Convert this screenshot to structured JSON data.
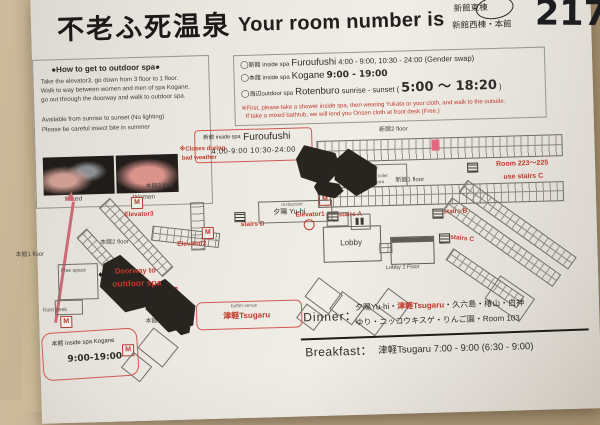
{
  "colors": {
    "table": "#b3a081",
    "paper": "#eae7e1",
    "accent_red": "#c0392b",
    "highlight_room": "#e2697f",
    "arrow_pink": "#c96a74"
  },
  "header": {
    "onsen_title": "不老ふ死温泉",
    "room_number_label": "Your room number is",
    "wing_circled": "新館東棟",
    "wing_alt": "新館西棟・本館",
    "room_number": "217"
  },
  "howto_box": {
    "title": "●How to get to outdoor spa●",
    "body_lines": [
      "Take the elevator3, go down from 3 floor to 1 floor.",
      "Walk to way between women and men of spa Kogane,",
      "go out through the doorway and walk to outdoor spa."
    ],
    "note1": "Available from sunrise to sunset (No lighting)",
    "note2": "Please be careful insect bite in summer",
    "photo_label_left": "Mixed",
    "photo_label_right": "Women",
    "closure_line1": "※Closes during",
    "closure_line2": "bad weather"
  },
  "hours_box": {
    "furoufushi": {
      "bullet": "◯",
      "place": "新館 inside spa",
      "name": "Furoufushi",
      "time": "4:00 - 9:00, 10:30 - 24:00 (Gender swap)"
    },
    "kogane": {
      "bullet": "◯",
      "place": "本館 inside spa",
      "name": "Kogane",
      "time": "9:00 - 19:00"
    },
    "rotenburo": {
      "bullet": "◯",
      "place": "海辺outdoor spa",
      "name": "Rotenburo",
      "prefix": "sunrise - sunset (",
      "time": "5:00 〜 18:20",
      "suffix": ")"
    },
    "warning_line1": "※First, please take a shower inside spa, then wearing Yukata or your cloth, and walk to the outside.",
    "warning_line2": "If take a mixed bathtub, we will lend you Onsen cloth at front desk (Free.)"
  },
  "furoufushi_box": {
    "place": "新館 inside spa",
    "name": "Furoufushi",
    "hours": "4:00-9:00  10:30-24:00"
  },
  "kogane_box": {
    "title": "本館 inside spa Kogane",
    "hours": "9:00-19:00"
  },
  "buffet_box": {
    "caption": "buffet venue",
    "name": "津軽Tsugaru"
  },
  "map": {
    "shinkan2_label": "新館2 floor",
    "shinkan1_label": "新館1 floor",
    "honkan3_label": "本館3 floor",
    "honkan2_label": "本館2 floor",
    "honkan1_label": "本館1 floor",
    "honkan1b_label": "本館1 floor",
    "note_box_lines": [
      "新館2F",
      "multipurpose toilet",
      "smoking area"
    ],
    "stairs_a": "stairs A",
    "stairs_b": "stairs B",
    "stairs_c": "stairs C",
    "stairs_d": "stairs D",
    "elevator1": "Elevator1",
    "elevator2": "Elevator2",
    "elevator3": "Elevator3",
    "rooms_note_line1": "Room 223〜225",
    "rooms_note_line2": "use stairs C",
    "lobby": "Lobby",
    "lobby2": "Lobby 2 Floor",
    "restaurant_caption": "restaurant",
    "restaurant_name": "夕陽 Yu-hi",
    "free_space": "Free space",
    "front_desk": "front desk",
    "doorway_line1": "Doorway to",
    "doorway_line2": "outdoor spa"
  },
  "meals": {
    "dinner_label": "Dinner：",
    "dinner_venues_pre": "夕陽Yu-hi・",
    "dinner_venue_highlight": "津軽Tsugaru",
    "dinner_venues_post": "・久六島・椿山・白神",
    "dinner_venues_line2": "ゆり・ニッコウキスゲ・りんご園・Room 103",
    "breakfast_label": "Breakfast：",
    "breakfast_value": "津軽Tsugaru 7:00 - 9:00 (6:30 - 9:00)"
  },
  "icons": {
    "elevator": "M",
    "arrow_left": "⬅"
  }
}
